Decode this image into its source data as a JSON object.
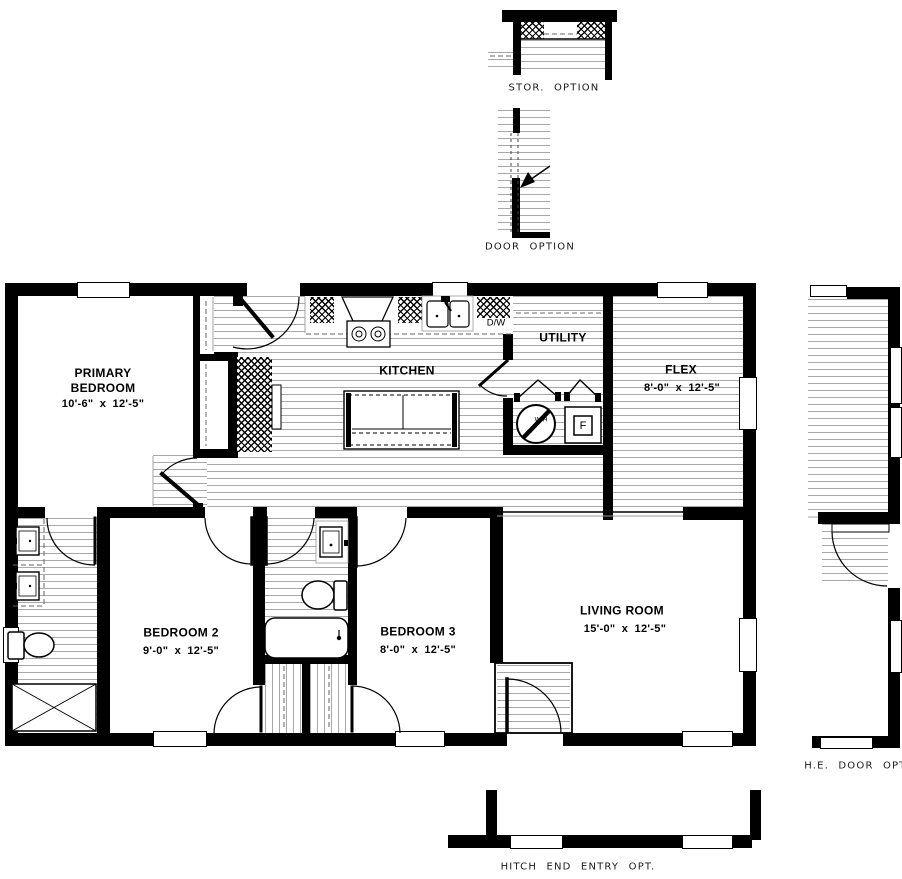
{
  "plan": {
    "rooms": [
      {
        "name": "PRIMARY BEDROOM",
        "dims": "10'-6\" x 12'-5\""
      },
      {
        "name": "KITCHEN",
        "dims": ""
      },
      {
        "name": "UTILITY",
        "dims": ""
      },
      {
        "name": "FLEX",
        "dims": "8'-0\" x 12'-5\""
      },
      {
        "name": "BEDROOM 2",
        "dims": "9'-0\" x 12'-5\""
      },
      {
        "name": "BEDROOM 3",
        "dims": "8'-0\" x 12'-5\""
      },
      {
        "name": "LIVING ROOM",
        "dims": "15'-0\" x 12'-5\""
      }
    ],
    "appliances": {
      "dishwasher": "D/W",
      "water_heater": "W/H",
      "furnace": "F"
    },
    "options": [
      {
        "label": "STOR. OPTION"
      },
      {
        "label": "DOOR OPTION"
      },
      {
        "label": "H.E. DOOR OPT."
      },
      {
        "label": "HITCH END ENTRY OPT."
      }
    ],
    "colors": {
      "wall": "#000000",
      "floor_line": "#a8a8a8",
      "background": "#ffffff"
    }
  }
}
